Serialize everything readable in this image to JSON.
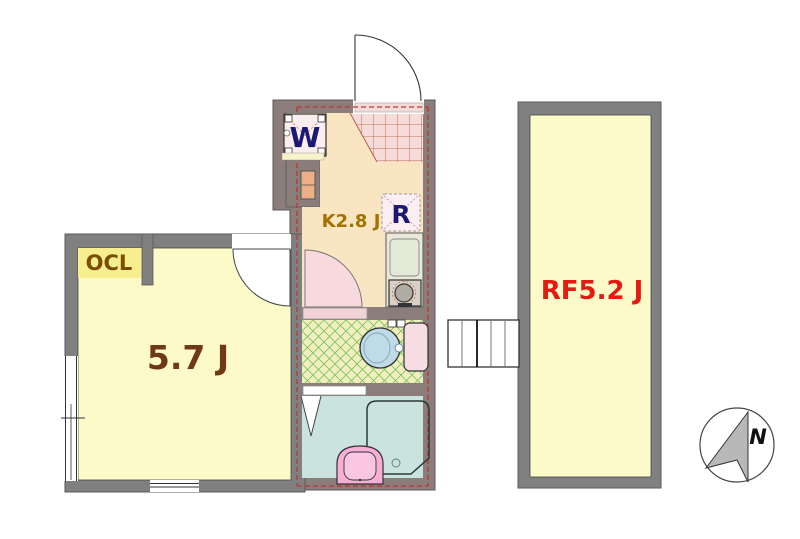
{
  "plan": {
    "rooms": {
      "main_room": {
        "label": "5.7 J"
      },
      "closet": {
        "label": "OCL"
      },
      "kitchen": {
        "label": "K2.8 J"
      },
      "loft": {
        "label": "RF5.2 J"
      }
    },
    "fixtures": {
      "washing_machine": {
        "label": "W"
      },
      "refrigerator": {
        "label": "R"
      }
    },
    "compass": {
      "north_label": "N"
    },
    "colors": {
      "wall_gray": "#808080",
      "wall_taupe": "#8B7D79",
      "room_yellow": "#FCFAC8",
      "closet_yellow": "#F7EE8F",
      "kitchen_orange": "#FAE5C2",
      "genkan_pink": "#F6DBDB",
      "genkan_grid": "#C4724A",
      "toilet_cream": "#F3EEC2",
      "lattice_green": "#7CC75A",
      "bath_blue": "#CBE3DF",
      "door_pink": "#F8D9DE",
      "threshold_pink": "#F3D2D6",
      "basin_pink": "#F8AFD7",
      "basin_inner_pink": "#FAC6E3",
      "toilet_bowl_blue": "#BFDBE8",
      "toilet_tank_pink": "#F7DCE4",
      "heater_orange": "#EBB086",
      "boundary_red": "#C23333",
      "label_brown": "#6F3916",
      "closet_label_brown": "#7A4E00",
      "label_gold": "#A27300",
      "label_navy": "#1A1A72",
      "label_red": "#E31B12",
      "compass_gray": "#B8B8B8"
    }
  }
}
